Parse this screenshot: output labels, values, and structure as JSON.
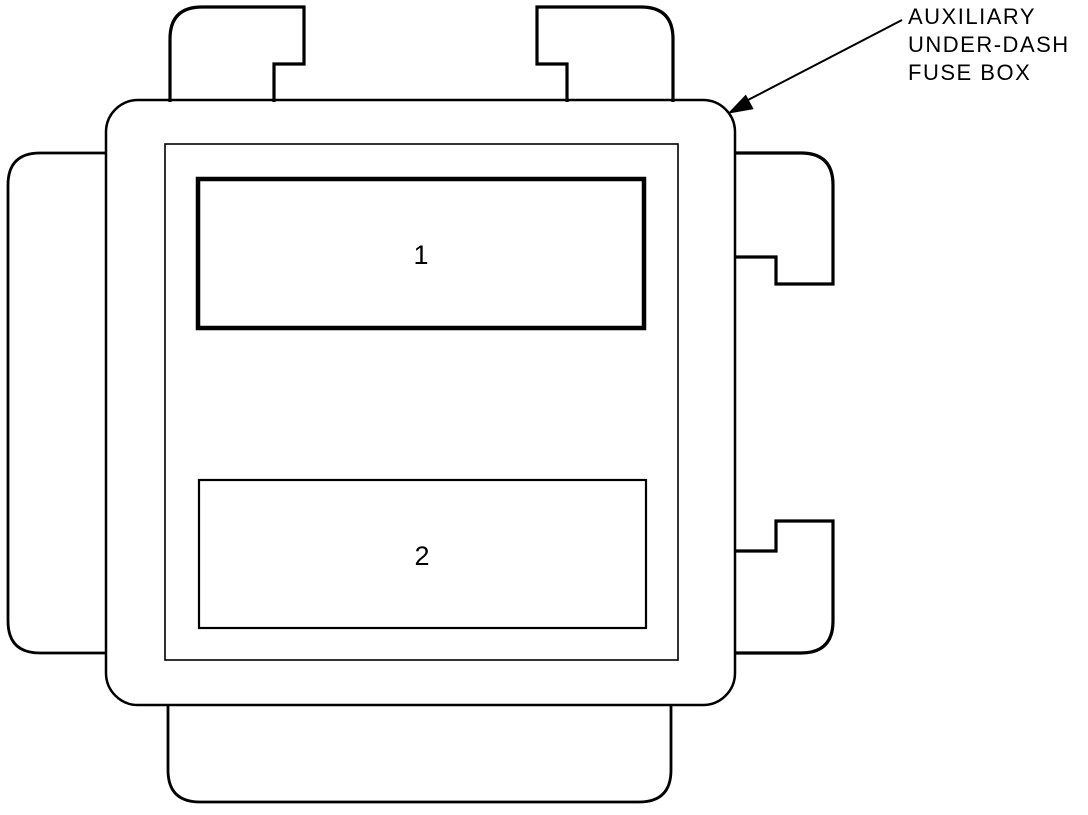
{
  "diagram": {
    "title": "Auxiliary under-dash fuse box",
    "callout": {
      "lines": [
        "AUXILIARY",
        "UNDER-DASH",
        "FUSE BOX"
      ]
    },
    "slots": [
      {
        "label": "1"
      },
      {
        "label": "2"
      }
    ],
    "colors": {
      "line": "#000000",
      "background": "#ffffff"
    }
  }
}
